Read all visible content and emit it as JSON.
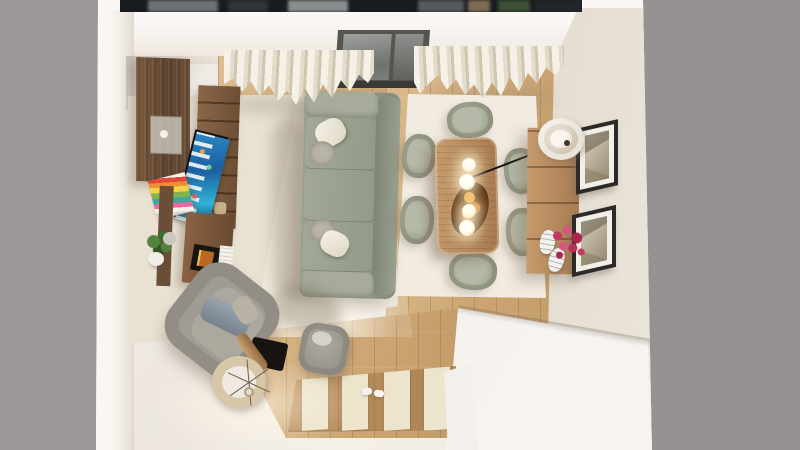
{
  "scene": {
    "description": "Top-down 3D rendering of a furnished living and dining room with sage seating, walnut furniture, sheer curtains, oak plank flooring and a striped entry rug, framed by a neutral gray backdrop.",
    "type": "interior-render",
    "view": "bird's-eye"
  },
  "palette": {
    "backdrop_gray": "#9a9596",
    "wall_white": "#f7f3f1",
    "wall_face_beige": "#ded6c9",
    "carpet_cream": "#e9e1d2",
    "wood_light": "#dcbd90",
    "wood_dark": "#c09a66",
    "dining_rug_ivory": "#f1ebe1",
    "sofa_sage": "#99a091",
    "chair_sage": "#9aa08c",
    "pillow_white": "#f6f2e6",
    "table_walnut": "#b4835a",
    "cabinet_walnut": "#6e5138",
    "tv_screen_blue": "#1e78b6",
    "flower_magenta": "#b8305c",
    "pendant_glow": "#fff3d4",
    "frame_black": "#2b2a28",
    "curtain_cream": "#f2ecdf",
    "window_glass": "#84878a",
    "entry_rug_cream": "#ece4cb"
  },
  "objects": {
    "backdrop": {
      "label": "Neutral gray backdrop"
    },
    "outside_view": {
      "label": "Blurred shelf view beyond top wall"
    },
    "room": {
      "label": "Living-dining room, top-down view"
    },
    "window": {
      "label": "Sliding window with gray glass"
    },
    "curtain_left": {
      "label": "Sheer curtain panel (left)"
    },
    "curtain_right": {
      "label": "Sheer curtain panel (right)"
    },
    "wardrobe": {
      "label": "Wall-mounted walnut cabinet with frosted door"
    },
    "bookshelf": {
      "label": "Walnut shelving unit"
    },
    "tv": {
      "label": "Flat-screen TV showing blue smart-TV screen"
    },
    "book_stack": {
      "label": "Stack of colorful books"
    },
    "ledge": {
      "label": "Wooden wall ledge"
    },
    "desk": {
      "label": "Walnut side cabinet"
    },
    "tray": {
      "label": "Black tray with orange book"
    },
    "white_box": {
      "label": "White carved box"
    },
    "plant": {
      "label": "Potted green plant"
    },
    "gray_vase": {
      "label": "Gray vase"
    },
    "sofa": {
      "label": "Sage three-seat sofa with cushions"
    },
    "pillows": {
      "label": "White and taupe throw pillows"
    },
    "living_rug": {
      "label": "Cream living-room carpet"
    },
    "sunlight": {
      "label": "Window light patch on carpet"
    },
    "dining_rug": {
      "label": "Ivory rug under dining set"
    },
    "dining_table": {
      "label": "Walnut dining table"
    },
    "dining_chair": {
      "label": "Sage upholstered dining chair"
    },
    "pendant": {
      "label": "Glowing pendant globe"
    },
    "platter": {
      "label": "Dark serving platter with fruit"
    },
    "sideboard": {
      "label": "Walnut sideboard"
    },
    "table_lamp": {
      "label": "Round cream table lamp"
    },
    "vase": {
      "label": "Striped white vase"
    },
    "flowers": {
      "label": "Magenta flower bouquet"
    },
    "frame_top": {
      "label": "Framed sketch (upper)"
    },
    "frame_bottom": {
      "label": "Framed sketch (lower)"
    },
    "armchair": {
      "label": "Gray boucle armchair with blue pillow"
    },
    "pouf": {
      "label": "Gray pouf"
    },
    "floor_lamp": {
      "label": "Drum-shade floor lamp seen from above"
    },
    "lamp_mat": {
      "label": "Black floor mat"
    },
    "entry_rug": {
      "label": "Striped wood-and-cream entry rug"
    },
    "slippers": {
      "label": "White slippers"
    },
    "platform": {
      "label": "White platform step at entry"
    },
    "wood_floor": {
      "label": "Oak plank flooring"
    }
  }
}
